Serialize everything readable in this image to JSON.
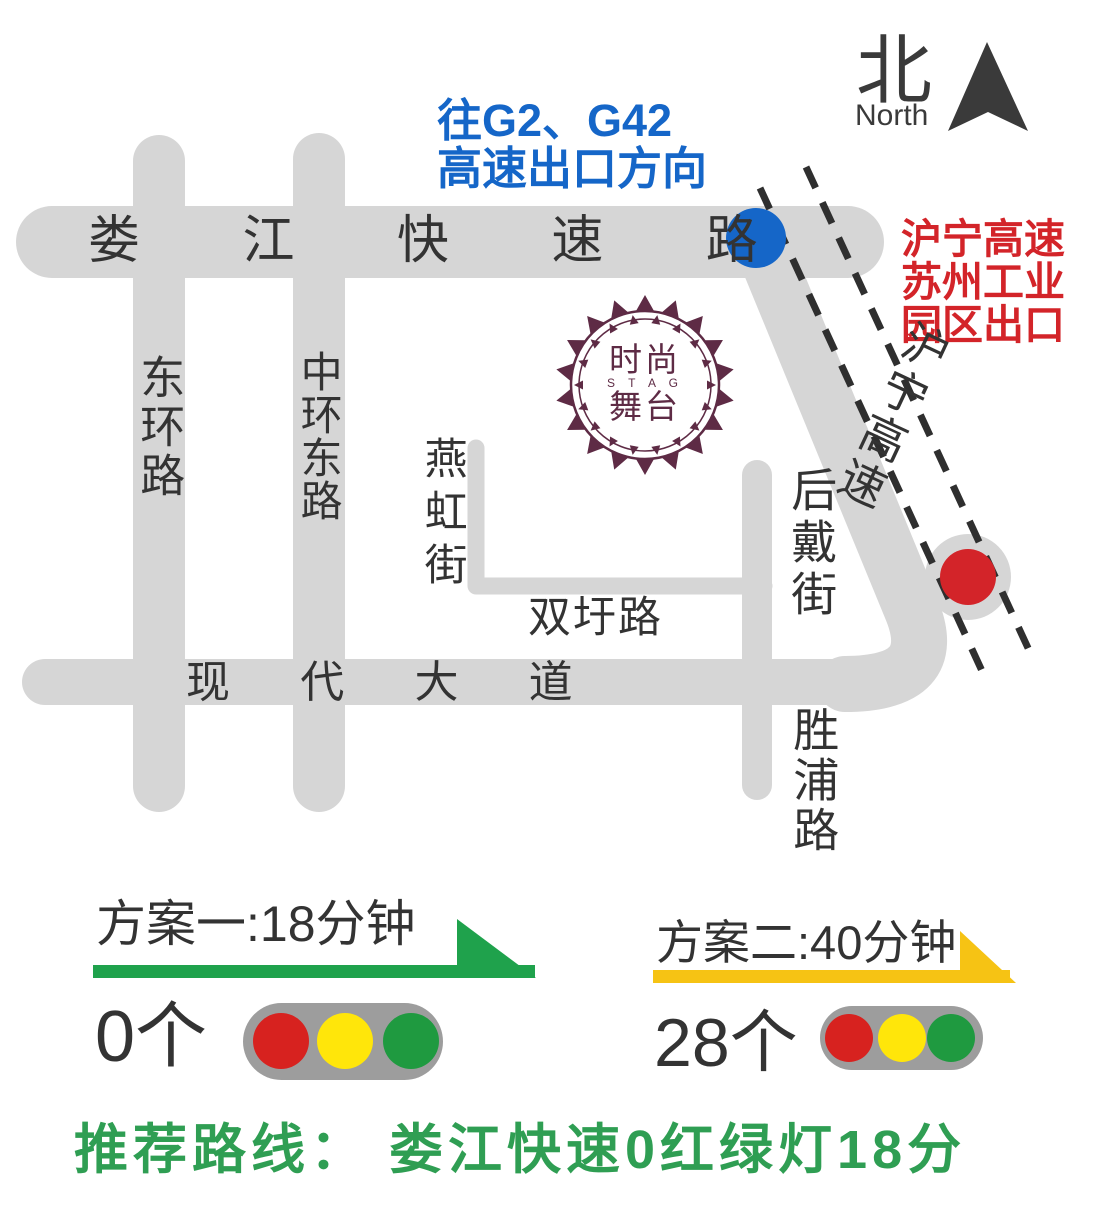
{
  "poster": {
    "north": {
      "zh": "北",
      "en": "North"
    },
    "roads": {
      "loujiang": "娄 江 快 速 路",
      "donghuan": "东环路",
      "zhonghuandong": "中环东路",
      "yanhong": "燕虹街",
      "shuangwei": "双圩路",
      "xiandai": "现 代 大 道",
      "houdai": "后戴街",
      "shengpu": "胜浦路",
      "huning": "沪宁高速"
    },
    "notes": {
      "g2_line1": "往G2、G42",
      "g2_line2": "高速出口方向",
      "exit_line1": "沪宁高速",
      "exit_line2": "苏州工业",
      "exit_line3": "园区出口"
    },
    "logo": {
      "zh_top": "时尚",
      "latin": "S T A G",
      "zh_bottom": "舞台"
    },
    "plans": {
      "plan1": {
        "title": "方案一:18分钟",
        "lights": "0个"
      },
      "plan2": {
        "title": "方案二:40分钟",
        "lights": "28个"
      }
    },
    "recommendation": "推荐路线： 娄江快速0红绿灯18分"
  },
  "colors": {
    "road_gray": "#d6d6d6",
    "blue": "#1566c8",
    "red": "#d32429",
    "green": "#1fa24c",
    "yellow": "#f6c314",
    "maroon": "#5e2b45",
    "pill_gray": "#9d9d9d",
    "traffic_red": "#d7221f",
    "traffic_yellow": "#ffe60a",
    "traffic_green": "#1f9a40",
    "ink": "#333333"
  }
}
